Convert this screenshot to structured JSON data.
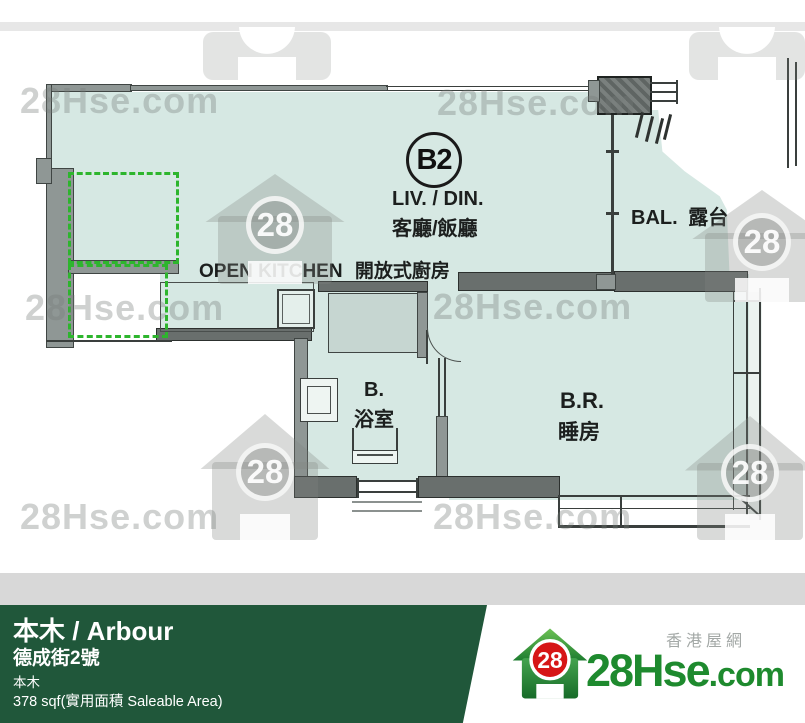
{
  "watermark": {
    "text": "28Hse.com",
    "badge": "28"
  },
  "plan": {
    "unit": "B2",
    "living_en": "LIV. / DIN.",
    "living_zh": "客廳/飯廳",
    "kitchen_en": "OPEN KITCHEN",
    "kitchen_zh": "開放式廚房",
    "balcony_en": "BAL.",
    "balcony_zh": "露台",
    "bath_en": "B.",
    "bath_zh": "浴室",
    "bedroom_en": "B.R.",
    "bedroom_zh": "睡房"
  },
  "footer": {
    "title": "本木 / Arbour",
    "address": "德成街2號",
    "estate": "本木",
    "area": "378 sqf(實用面積 Saleable Area)",
    "site_zh": "香港屋網",
    "logo_main": "28Hse",
    "logo_suffix": ".com",
    "logo_badge": "28",
    "colors": {
      "bar_green": "#20573a",
      "logo_green": "#1e8a2e",
      "logo_red": "#d61616",
      "room_fill": "#d6e8e3",
      "dashed_green": "#2db52d"
    }
  }
}
